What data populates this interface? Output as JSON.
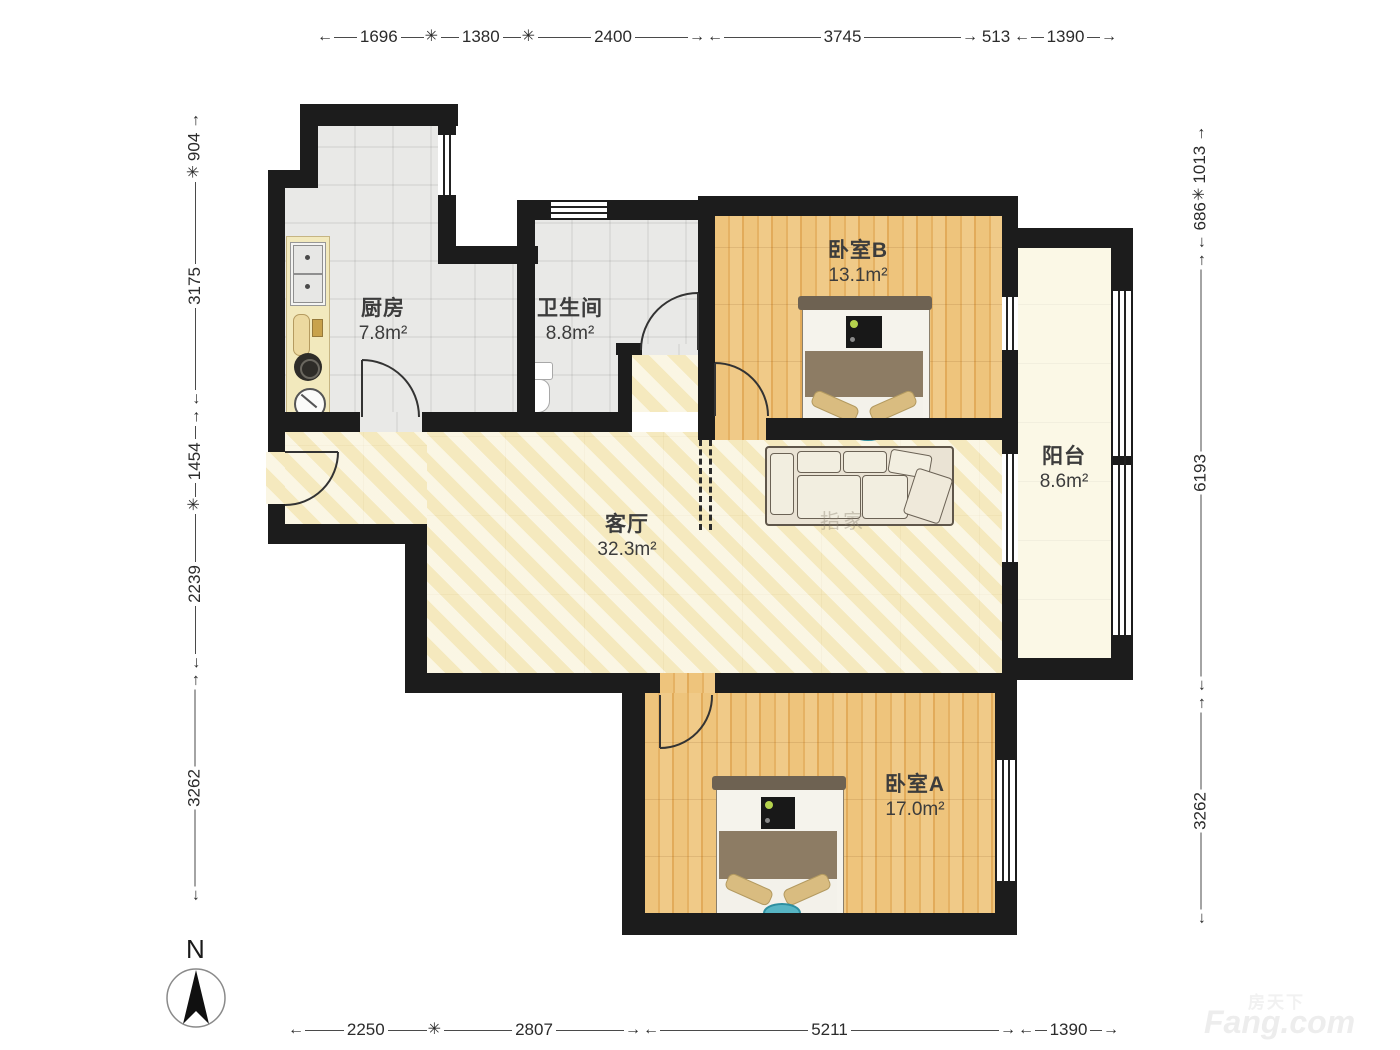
{
  "north": {
    "label": "N"
  },
  "rooms": [
    {
      "name": "厨房",
      "area": "7.8m²"
    },
    {
      "name": "卫生间",
      "area": "8.8m²"
    },
    {
      "name": "卧室B",
      "area": "13.1m²"
    },
    {
      "name": "阳台",
      "area": "8.6m²"
    },
    {
      "name": "客厅",
      "area": "32.3m²"
    },
    {
      "name": "卧室A",
      "area": "17.0m²"
    }
  ],
  "dimensions": {
    "top": [
      {
        "value": "1696",
        "a": "←",
        "b": "✳"
      },
      {
        "value": "1380",
        "a": "",
        "b": "✳"
      },
      {
        "value": "2400",
        "a": "",
        "b": "→"
      },
      {
        "value": "3745",
        "a": "←",
        "b": "→"
      },
      {
        "value": "513",
        "a": "",
        "b": ""
      },
      {
        "value": "1390",
        "a": "←",
        "b": "→"
      }
    ],
    "bottom": [
      {
        "value": "2250",
        "a": "←",
        "b": "✳"
      },
      {
        "value": "2807",
        "a": "",
        "b": "→"
      },
      {
        "value": "5211",
        "a": "←",
        "b": "→"
      },
      {
        "value": "1390",
        "a": "←",
        "b": "→"
      }
    ],
    "left": [
      {
        "value": "904",
        "a": "✳",
        "b": "→"
      },
      {
        "value": "3175",
        "a": "←",
        "b": ""
      },
      {
        "value": "1454",
        "a": "✳",
        "b": "→"
      },
      {
        "value": "2239",
        "a": "←",
        "b": ""
      },
      {
        "value": "3262",
        "a": "←",
        "b": "→"
      }
    ],
    "right": [
      {
        "value": "1013",
        "a": "✳",
        "b": "→"
      },
      {
        "value": "686",
        "a": "←",
        "b": ""
      },
      {
        "value": "6193",
        "a": "←",
        "b": "→"
      },
      {
        "value": "3262",
        "a": "←",
        "b": "→"
      }
    ]
  },
  "watermark": {
    "site_cn": "房天下",
    "site_en": "Fang.com",
    "plan_mark": "指家"
  },
  "colors": {
    "wall": "#1c1c1c",
    "wood_floor": "#ecc076",
    "tile_floor": "#e9e9e7",
    "living_floor": "#f7efcd",
    "balcony_floor": "#fbf8e6",
    "accent_blue": "#57b5c4"
  }
}
